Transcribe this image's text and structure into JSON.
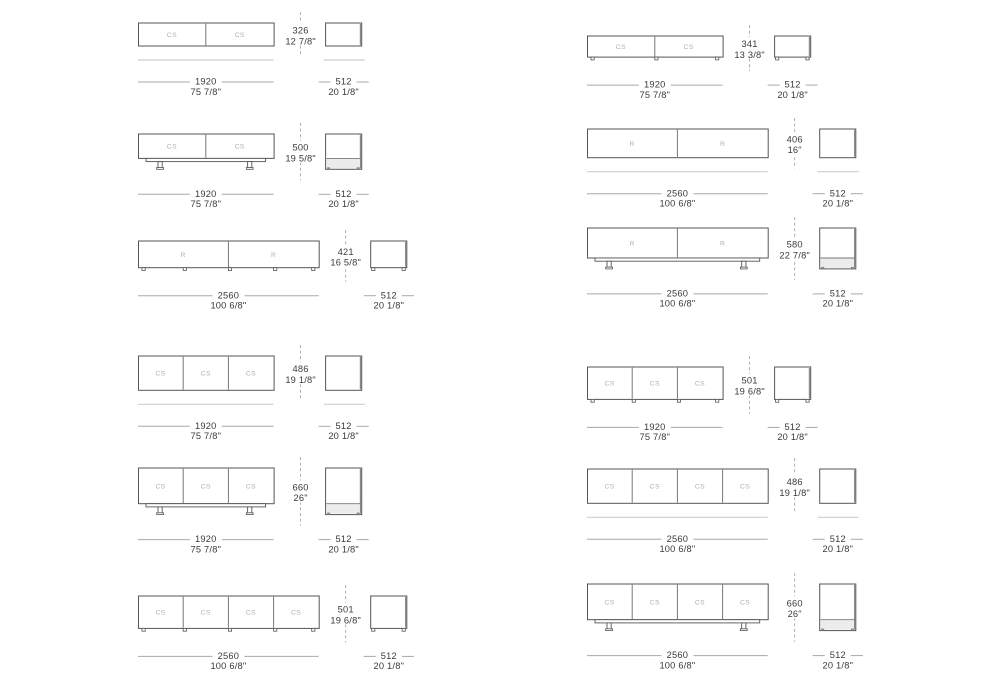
{
  "sheet": {
    "background": "#ffffff",
    "description": "Furniture sideboard dimension spec sheet, 12 technical drawings"
  },
  "colors": {
    "line": "#555555",
    "divider": "#777777",
    "compartment_label": "#b0b0b0",
    "dim_text": "#3a3a3a",
    "dim_line": "#a8a8a8",
    "floor_line": "#cfcfcf",
    "dash_line": "#9b9b9b",
    "edge_shadow": "#8a8a8a",
    "base_band_fill": "#ececec",
    "foot_fill": "#888888"
  },
  "drawings": [
    {
      "id": "left-1",
      "column": "left",
      "row": 1,
      "compartments": [
        "CS",
        "CS"
      ],
      "base": "floating",
      "width_mm": 1920,
      "height_mm": 326,
      "depth_mm": 512,
      "width_label": {
        "mm": "1920",
        "inches": "75 7/8\""
      },
      "height_label": {
        "mm": "326",
        "inches": "12 7/8\""
      },
      "depth_label": {
        "mm": "512",
        "inches": "20 1/8\""
      }
    },
    {
      "id": "left-2",
      "column": "left",
      "row": 2,
      "compartments": [
        "CS",
        "CS"
      ],
      "base": "legs",
      "width_mm": 1920,
      "height_mm": 500,
      "depth_mm": 512,
      "width_label": {
        "mm": "1920",
        "inches": "75 7/8\""
      },
      "height_label": {
        "mm": "500",
        "inches": "19 5/8\""
      },
      "depth_label": {
        "mm": "512",
        "inches": "20 1/8\""
      }
    },
    {
      "id": "left-3",
      "column": "left",
      "row": 3,
      "compartments": [
        "R",
        "R"
      ],
      "base": "feet",
      "width_mm": 2560,
      "height_mm": 421,
      "depth_mm": 512,
      "width_label": {
        "mm": "2560",
        "inches": "100 6/8\""
      },
      "height_label": {
        "mm": "421",
        "inches": "16 5/8\""
      },
      "depth_label": {
        "mm": "512",
        "inches": "20 1/8\""
      }
    },
    {
      "id": "left-4",
      "column": "left",
      "row": 4,
      "compartments": [
        "CS",
        "CS",
        "CS"
      ],
      "base": "floating",
      "width_mm": 1920,
      "height_mm": 486,
      "depth_mm": 512,
      "width_label": {
        "mm": "1920",
        "inches": "75 7/8\""
      },
      "height_label": {
        "mm": "486",
        "inches": "19 1/8\""
      },
      "depth_label": {
        "mm": "512",
        "inches": "20 1/8\""
      }
    },
    {
      "id": "left-5",
      "column": "left",
      "row": 5,
      "compartments": [
        "CS",
        "CS",
        "CS"
      ],
      "base": "legs",
      "width_mm": 1920,
      "height_mm": 660,
      "depth_mm": 512,
      "width_label": {
        "mm": "1920",
        "inches": "75 7/8\""
      },
      "height_label": {
        "mm": "660",
        "inches": "26\""
      },
      "depth_label": {
        "mm": "512",
        "inches": "20 1/8\""
      }
    },
    {
      "id": "left-6",
      "column": "left",
      "row": 6,
      "compartments": [
        "CS",
        "CS",
        "CS",
        "CS"
      ],
      "base": "feet",
      "width_mm": 2560,
      "height_mm": 501,
      "depth_mm": 512,
      "width_label": {
        "mm": "2560",
        "inches": "100 6/8\""
      },
      "height_label": {
        "mm": "501",
        "inches": "19 6/8\""
      },
      "depth_label": {
        "mm": "512",
        "inches": "20 1/8\""
      }
    },
    {
      "id": "right-1",
      "column": "right",
      "row": 1,
      "compartments": [
        "CS",
        "CS"
      ],
      "base": "feet",
      "width_mm": 1920,
      "height_mm": 341,
      "depth_mm": 512,
      "width_label": {
        "mm": "1920",
        "inches": "75 7/8\""
      },
      "height_label": {
        "mm": "341",
        "inches": "13 3/8\""
      },
      "depth_label": {
        "mm": "512",
        "inches": "20 1/8\""
      }
    },
    {
      "id": "right-2",
      "column": "right",
      "row": 2,
      "compartments": [
        "R",
        "R"
      ],
      "base": "floating",
      "width_mm": 2560,
      "height_mm": 406,
      "depth_mm": 512,
      "width_label": {
        "mm": "2560",
        "inches": "100 6/8\""
      },
      "height_label": {
        "mm": "406",
        "inches": "16\""
      },
      "depth_label": {
        "mm": "512",
        "inches": "20 1/8\""
      }
    },
    {
      "id": "right-3",
      "column": "right",
      "row": 3,
      "compartments": [
        "R",
        "R"
      ],
      "base": "legs",
      "width_mm": 2560,
      "height_mm": 580,
      "depth_mm": 512,
      "width_label": {
        "mm": "2560",
        "inches": "100 6/8\""
      },
      "height_label": {
        "mm": "580",
        "inches": "22 7/8\""
      },
      "depth_label": {
        "mm": "512",
        "inches": "20 1/8\""
      }
    },
    {
      "id": "right-4",
      "column": "right",
      "row": 4,
      "compartments": [
        "CS",
        "CS",
        "CS"
      ],
      "base": "feet",
      "width_mm": 1920,
      "height_mm": 501,
      "depth_mm": 512,
      "width_label": {
        "mm": "1920",
        "inches": "75 7/8\""
      },
      "height_label": {
        "mm": "501",
        "inches": "19 6/8\""
      },
      "depth_label": {
        "mm": "512",
        "inches": "20 1/8\""
      }
    },
    {
      "id": "right-5",
      "column": "right",
      "row": 5,
      "compartments": [
        "CS",
        "CS",
        "CS",
        "CS"
      ],
      "base": "floating",
      "width_mm": 2560,
      "height_mm": 486,
      "depth_mm": 512,
      "width_label": {
        "mm": "2560",
        "inches": "100 6/8\""
      },
      "height_label": {
        "mm": "486",
        "inches": "19 1/8\""
      },
      "depth_label": {
        "mm": "512",
        "inches": "20 1/8\""
      }
    },
    {
      "id": "right-6",
      "column": "right",
      "row": 6,
      "compartments": [
        "CS",
        "CS",
        "CS",
        "CS"
      ],
      "base": "legs",
      "width_mm": 2560,
      "height_mm": 660,
      "depth_mm": 512,
      "width_label": {
        "mm": "2560",
        "inches": "100 6/8\""
      },
      "height_label": {
        "mm": "660",
        "inches": "26\""
      },
      "depth_label": {
        "mm": "512",
        "inches": "20 1/8\""
      }
    }
  ]
}
